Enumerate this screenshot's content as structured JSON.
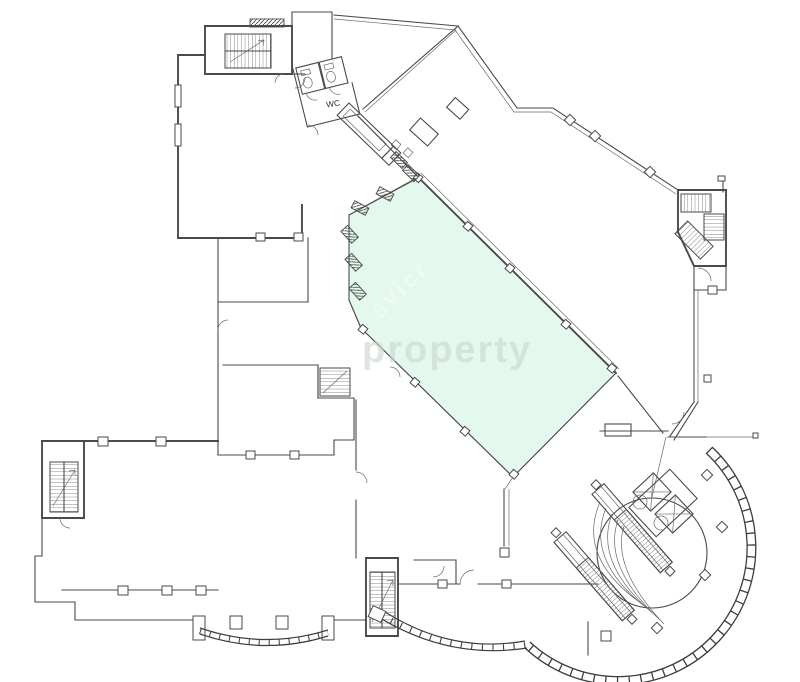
{
  "page": {
    "background": "#ffffff",
    "kind": "architectural floor plan drawing"
  },
  "floorplan": {
    "labels": {
      "wc": "WC"
    },
    "watermarks": {
      "horizontal_text": "property",
      "diagonal_text": "svicr"
    },
    "colors": {
      "walls": "#4a4a4a",
      "highlight_fill": "#e4f9ee",
      "highlight_edge": "#5d7f6b",
      "watermark_gray": "#ccd8cf",
      "watermark_white": "#f2fbf5"
    },
    "features": [
      "stairs-top-left",
      "stairs-right",
      "stairs-bottom-left",
      "stairs-bottom-middle",
      "wc-toilets",
      "escalator-ramp",
      "atrium-escalators",
      "elevator-bank",
      "circular-atrium",
      "curved-curtain-wall",
      "bay-window",
      "highlighted-unit",
      "structural-columns",
      "door-swings"
    ]
  }
}
